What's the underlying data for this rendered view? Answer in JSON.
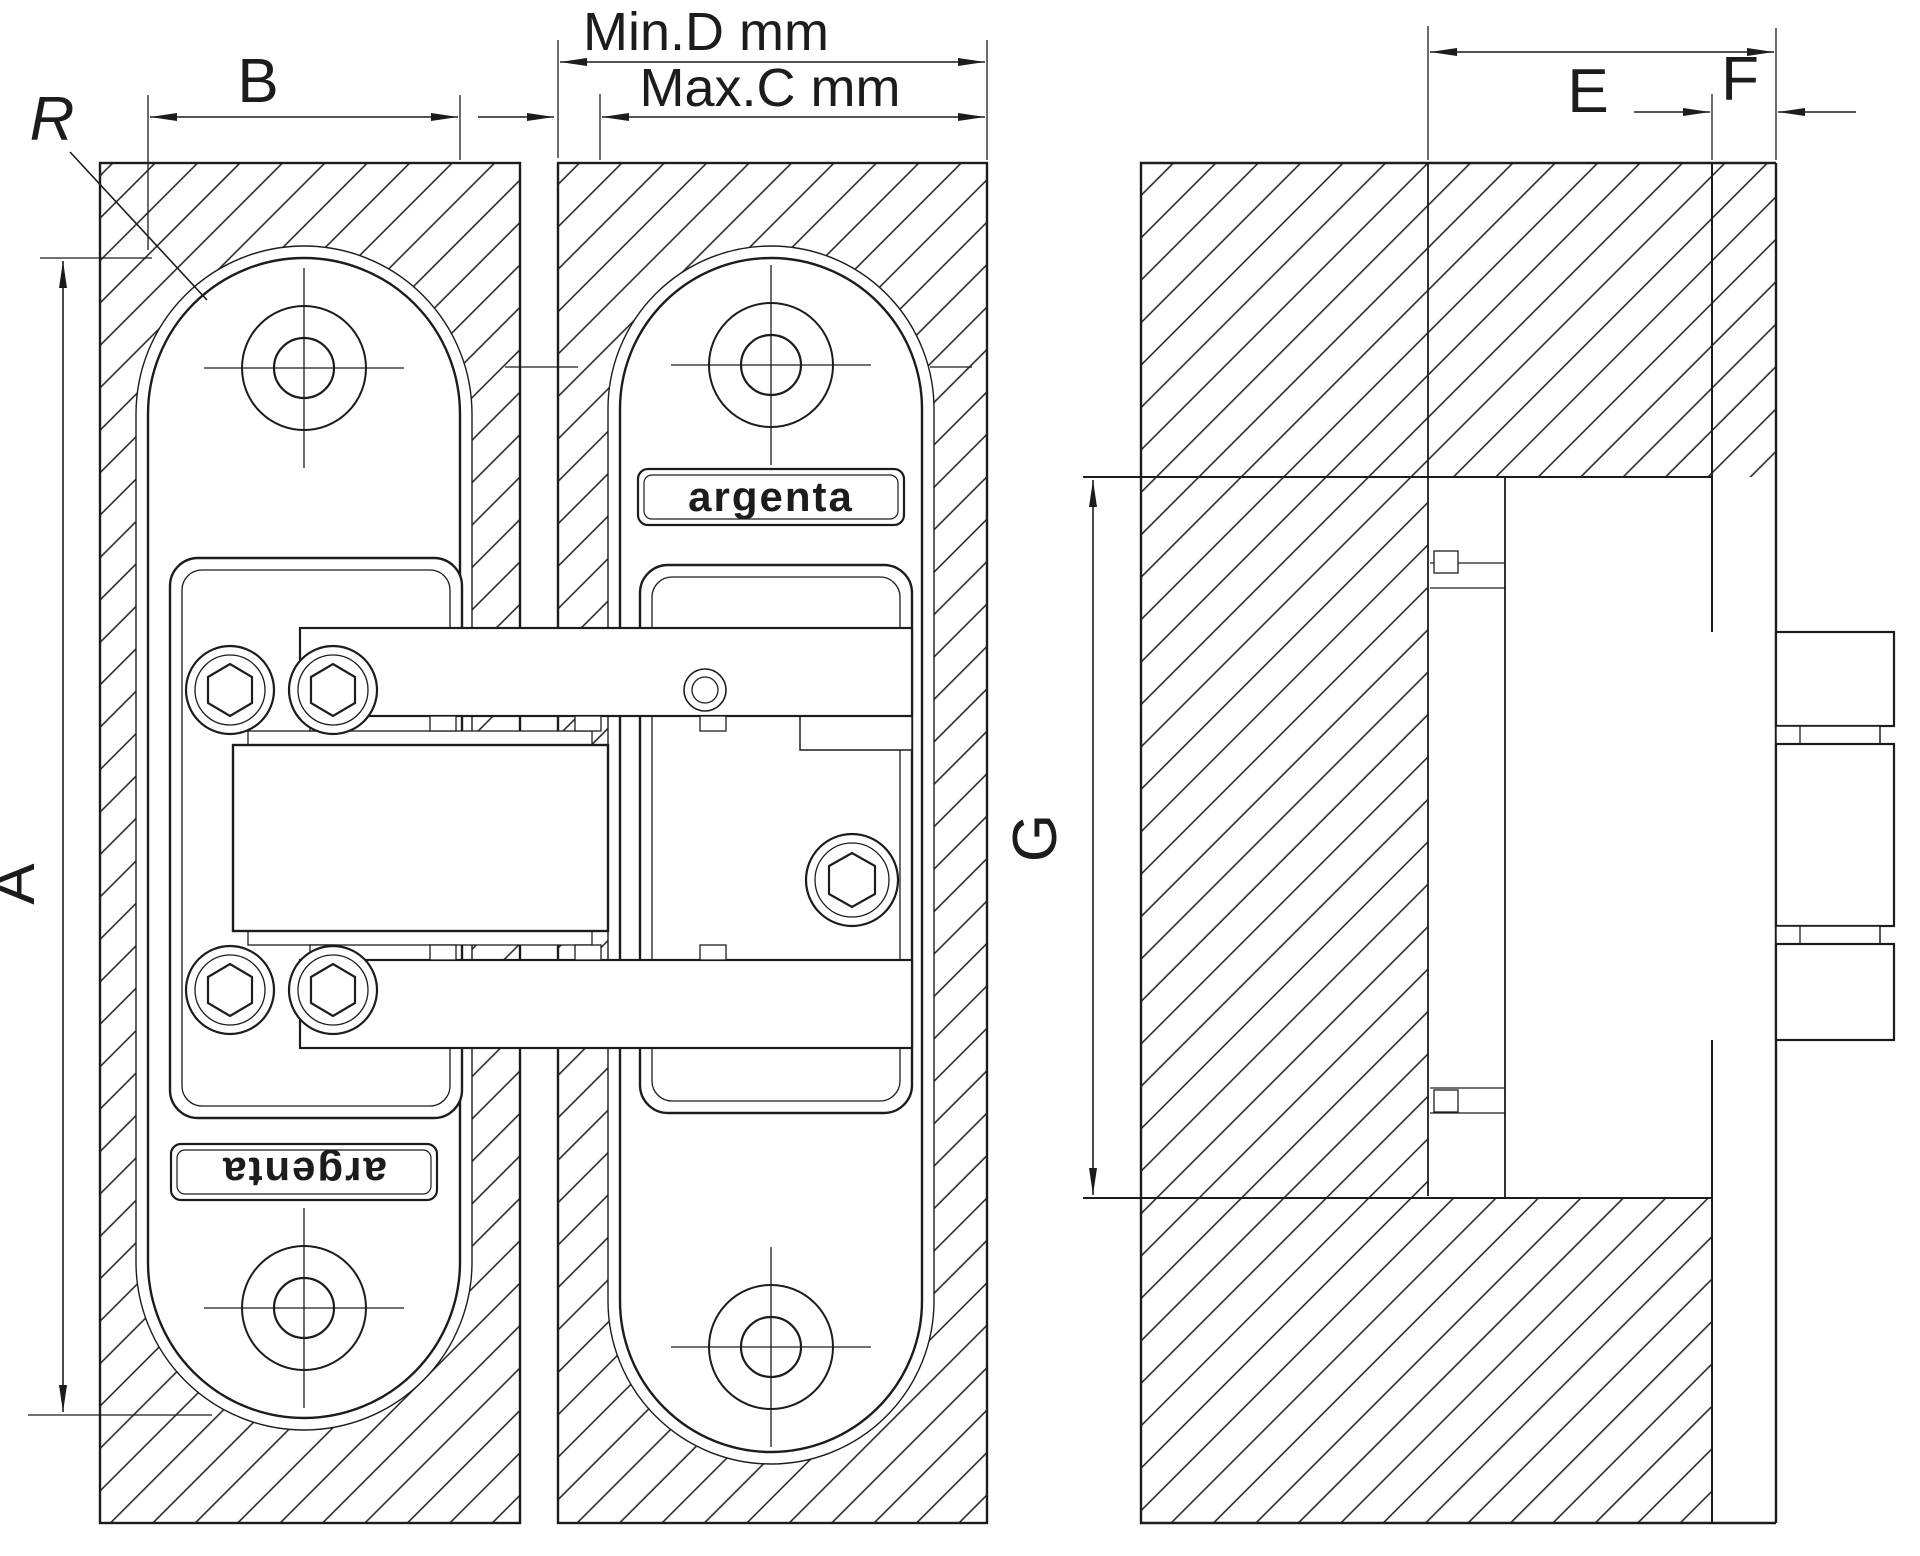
{
  "drawing": {
    "brand_front": "argenta",
    "brand_back": "argenta",
    "labels": {
      "radius": "R",
      "plate_width": "B",
      "min_depth": "Min.D mm",
      "max_thickness": "Max.C mm",
      "plate_height": "A",
      "mortise_depth": "E",
      "cover_thickness": "F",
      "mortise_height": "G"
    },
    "colors": {
      "line": "#1c1c1c",
      "background": "#ffffff"
    }
  }
}
